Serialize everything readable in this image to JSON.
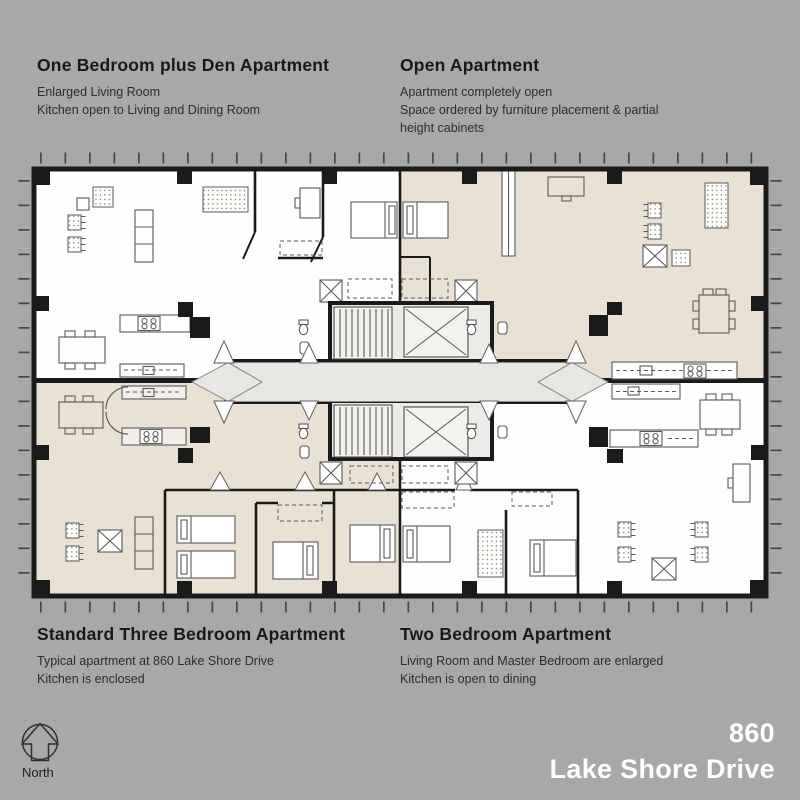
{
  "colors": {
    "background": "#a8a8a8",
    "plan_white": "#fefefe",
    "plan_beige": "#e9e1d3",
    "wall": "#1a1a1a",
    "corridor": "#e8e7e3",
    "furniture": "#5a5a5a",
    "title_color": "#ffffff",
    "text_color": "#222222"
  },
  "apartments": {
    "one_bedroom_den": {
      "title": "One Bedroom plus Den Apartment",
      "desc": "Enlarged Living Room\nKitchen open to Living and Dining Room"
    },
    "open": {
      "title": "Open Apartment",
      "desc": "Apartment completely open\nSpace ordered by furniture placement & partial\nheight cabinets"
    },
    "three_bedroom": {
      "title": "Standard Three Bedroom Apartment",
      "desc": "Typical apartment at 860 Lake Shore Drive\nKitchen is enclosed"
    },
    "two_bedroom": {
      "title": "Two Bedroom Apartment",
      "desc": "Living Room and Master Bedroom are enlarged\nKitchen is open to dining"
    }
  },
  "building": {
    "number": "860",
    "name": "Lake Shore Drive"
  },
  "compass": {
    "label": "North"
  }
}
